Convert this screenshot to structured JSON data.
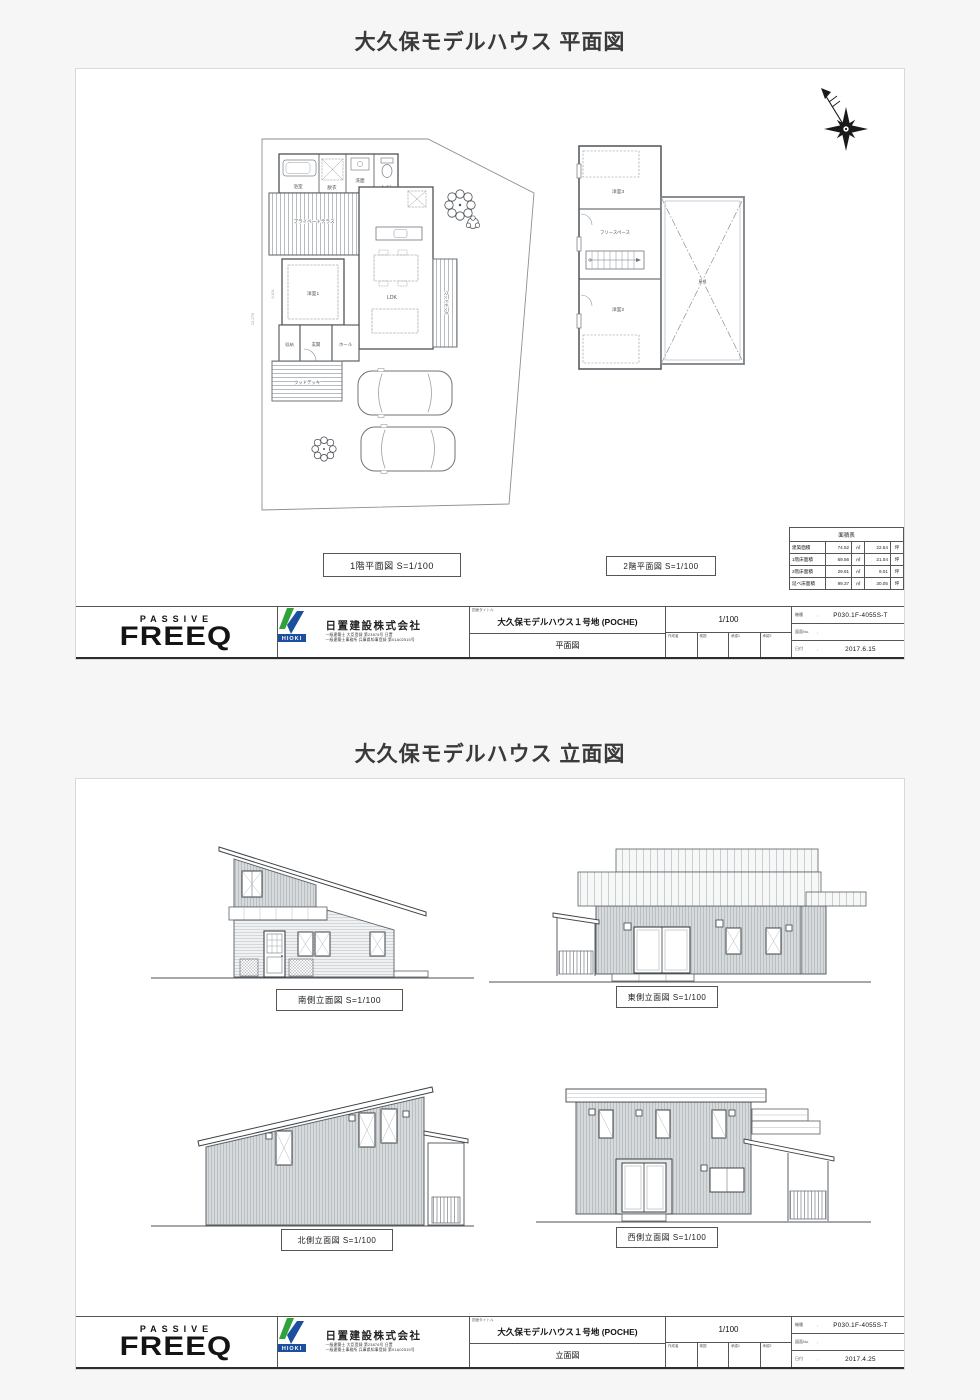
{
  "page": {
    "plan_title": "大久保モデルハウス 平面図",
    "elev_title": "大久保モデルハウス 立面図"
  },
  "plan_sheet": {
    "label_1f": "1階平面図 S=1/100",
    "label_2f": "2階平面図 S=1/100",
    "dims": {
      "left_height": "12,276",
      "left_room": "9,101"
    },
    "rooms_1f": {
      "bath": "浴室",
      "dressing": "脱衣",
      "wash": "洗面",
      "toilet": "トイレ",
      "terrace": "プライベートテラス",
      "room1": "洋室1",
      "ldk": "LDK",
      "storage": "収納",
      "entrance": "玄関",
      "hall": "ホール",
      "wood_deck": "ウッドデッキ",
      "side_deck": "ウッドデッキ"
    },
    "rooms_2f": {
      "room3": "洋室3",
      "free_space": "フリースペース",
      "room2": "洋室2",
      "roof": "屋根"
    },
    "area_table": {
      "title": "面積表",
      "rows": [
        {
          "label": "建築面積",
          "sqm": "74.52",
          "sqm_unit": "㎡",
          "tsubo": "22.54",
          "tsubo_unit": "坪"
        },
        {
          "label": "1階床面積",
          "sqm": "69.56",
          "sqm_unit": "㎡",
          "tsubo": "21.04",
          "tsubo_unit": "坪"
        },
        {
          "label": "2階床面積",
          "sqm": "29.81",
          "sqm_unit": "㎡",
          "tsubo": "9.01",
          "tsubo_unit": "坪"
        },
        {
          "label": "延べ床面積",
          "sqm": "99.37",
          "sqm_unit": "㎡",
          "tsubo": "30.05",
          "tsubo_unit": "坪"
        }
      ]
    }
  },
  "elev_sheet": {
    "south_label": "南側立面図 S=1/100",
    "east_label": "東側立面図 S=1/100",
    "north_label": "北側立面図 S=1/100",
    "west_label": "西側立面図 S=1/100"
  },
  "title_block": {
    "brand_top": "PASSIVE",
    "brand_main": "FREEQ",
    "logo_text": "HIOKI",
    "company_name": "日置建設株式会社",
    "reg_line1": "一級建築士 大臣登録 第23876号 日置",
    "reg_line2": "一級建築士事務所 兵庫県知事登録 第01A02515号",
    "drawing_title_label": "図面タイトル",
    "project_name": "大久保モデルハウス１号地 (POCHE)",
    "scale": "1/100",
    "approval_cols": [
      "作成者",
      "検図",
      "承認1",
      "承認2"
    ],
    "model_label": "機種",
    "model_value": "P030.1F-4055S-T",
    "drawing_no_label": "図面No.",
    "drawing_no_value": "",
    "date_label": "日付",
    "plan": {
      "drawing_type": "平面図",
      "date": "2017.6.15"
    },
    "elev": {
      "drawing_type": "立面図",
      "date": "2017.4.25"
    }
  },
  "colors": {
    "logo_green": "#2fa33a",
    "logo_blue": "#1c4f9e",
    "ink": "#333333",
    "line": "#5a6065"
  }
}
